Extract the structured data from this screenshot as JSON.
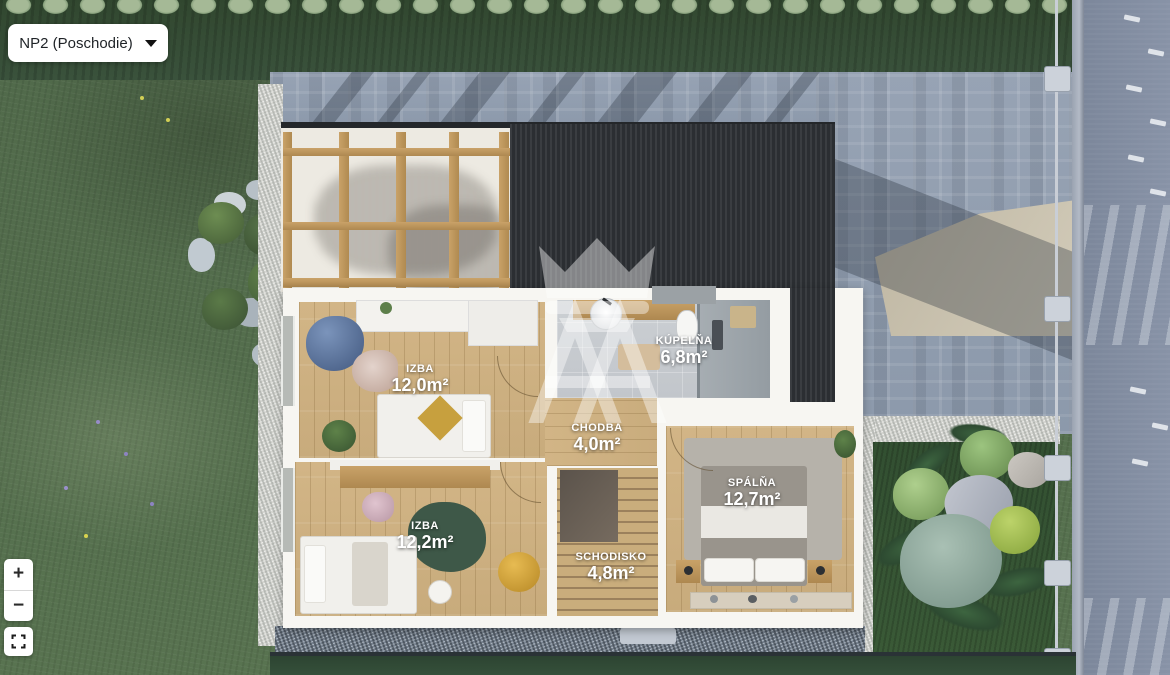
{
  "viewer": {
    "floor_selector": {
      "value": "NP2 (Poschodie)"
    },
    "zoom_controls": {
      "zoom_in": "+",
      "zoom_out": "−"
    },
    "icons": {
      "caret": "caret-down-triangle",
      "fullscreen": "fullscreen-corner-brackets",
      "watermark": "crown-double-a-monogram"
    }
  },
  "floorplan": {
    "rooms": [
      {
        "id": "izba-1",
        "name": "IZBA",
        "area": "12,0m²"
      },
      {
        "id": "kupelna",
        "name": "KÚPEĽŇA",
        "area": "6,8m²"
      },
      {
        "id": "chodba",
        "name": "CHODBA",
        "area": "4,0m²"
      },
      {
        "id": "izba-2",
        "name": "IZBA",
        "area": "12,2m²"
      },
      {
        "id": "spalna",
        "name": "SPÁLŇA",
        "area": "12,7m²"
      },
      {
        "id": "schodisko",
        "name": "SCHODISKO",
        "area": "4,8m²"
      }
    ]
  },
  "colors": {
    "panel": "#ffffff",
    "text": "#1f2327",
    "label_text": "#ffffff",
    "roof_dark": "#333639",
    "wood_floor": "#cfb486",
    "grass": "#55704c",
    "pavers": "#96a2b3"
  }
}
